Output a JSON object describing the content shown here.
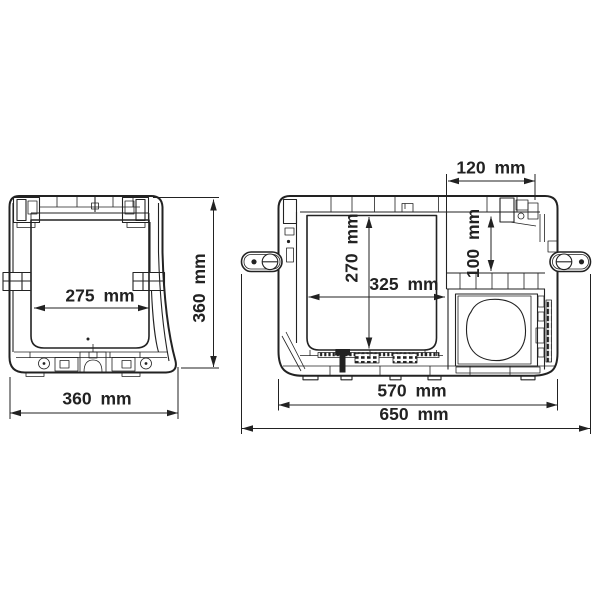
{
  "colors": {
    "line": "#222222",
    "background": "#ffffff"
  },
  "views": {
    "side": {
      "dims": {
        "interior_width": "275 mm",
        "overall_height": "360 mm",
        "overall_depth": "360 mm"
      }
    },
    "front": {
      "dims": {
        "compressor_top_width": "120 mm",
        "interior_height": "270 mm",
        "step_height": "100 mm",
        "interior_width": "325 mm",
        "body_width": "570 mm",
        "overall_width": "650 mm"
      }
    }
  }
}
